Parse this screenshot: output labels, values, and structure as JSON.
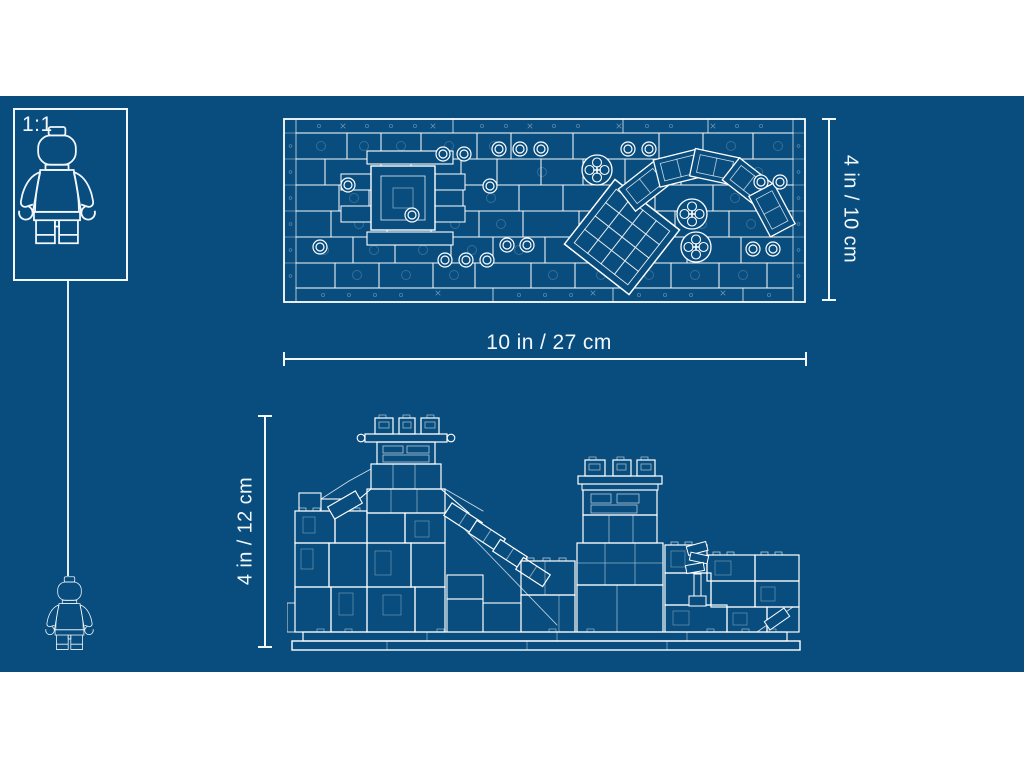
{
  "scale_box": {
    "label": "1:1"
  },
  "plan_view": {
    "width_label": "10 in / 27 cm",
    "depth_label": "4 in / 10 cm"
  },
  "elevation_view": {
    "height_label": "4 in / 12 cm"
  },
  "colors": {
    "background": "#FFFFFF",
    "blueprint_blue": "#084D7E",
    "line_white": "#F2F7FB"
  },
  "icons": {
    "scale_figure": "minifigure-front-icon",
    "small_figure": "minifigure-front-icon"
  }
}
